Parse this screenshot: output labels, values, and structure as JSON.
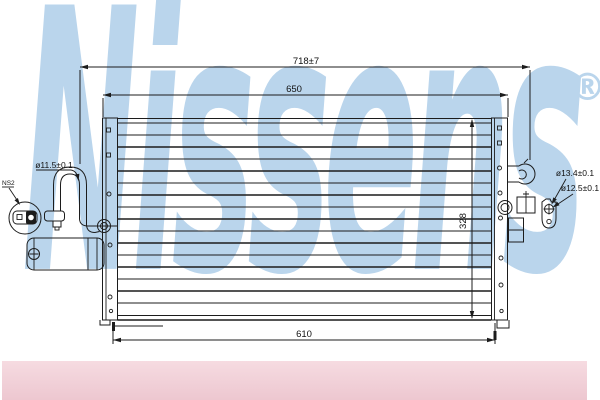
{
  "brand": {
    "watermark_text": "Nissens",
    "registered_mark": "®"
  },
  "drawing": {
    "dimensions": {
      "total_width": "718±7",
      "upper_width": "650",
      "lower_width": "610",
      "core_height": "328",
      "left_port_diameter": "ø11.5±0.1",
      "right_port_diameter_outer": "ø13.4±0.1",
      "right_port_diameter_inner": "ø12.5±0.1",
      "left_note": "NS2"
    }
  },
  "colors": {
    "watermark": "#bad5ec",
    "line": "#1c1c1c",
    "footer_bar_top": "#f6dbe1",
    "footer_bar_bottom": "#edc7d0",
    "background": "#ffffff"
  }
}
